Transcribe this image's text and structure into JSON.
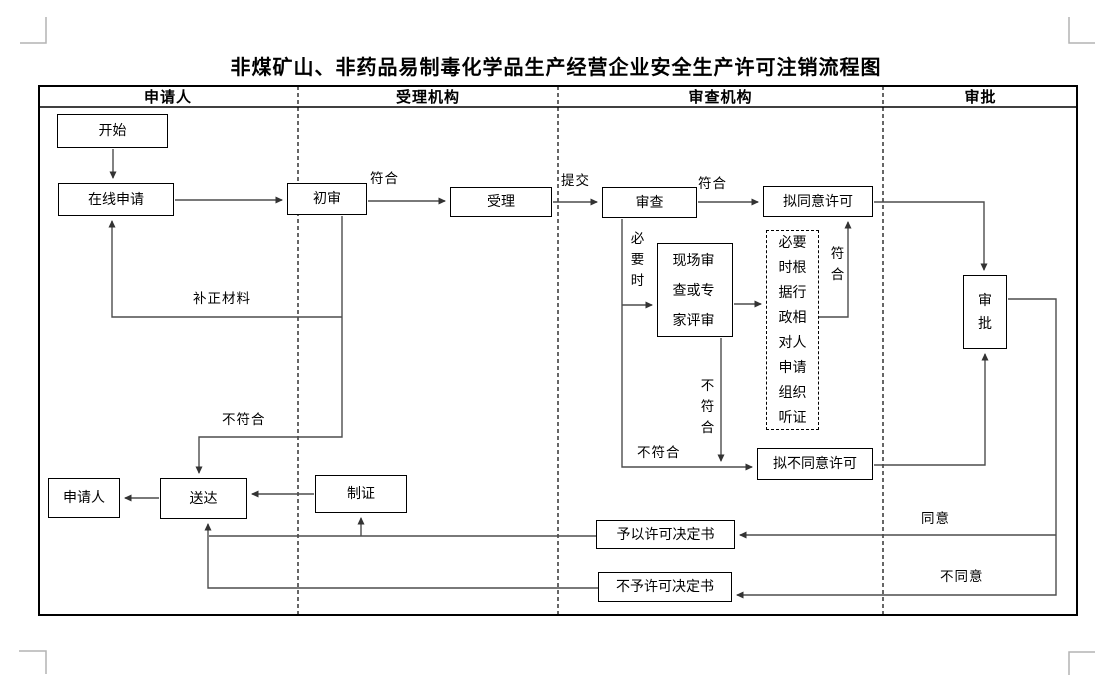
{
  "title": "非煤矿山、非药品易制毒化学品生产经营企业安全生产许可注销流程图",
  "lanes": [
    {
      "label": "申请人"
    },
    {
      "label": "受理机构"
    },
    {
      "label": "审查机构"
    },
    {
      "label": "审批"
    }
  ],
  "nodes": {
    "start": "开始",
    "online_apply": "在线申请",
    "preliminary_review": "初审",
    "accept": "受理",
    "review": "审查",
    "propose_approve": "拟同意许可",
    "onsite_review": "现场审查或专家评审",
    "hearing": "必要时根据行政相对人申请组织听证",
    "propose_disapprove": "拟不同意许可",
    "approve": "审批",
    "applicant": "申请人",
    "deliver": "送达",
    "make_certificate": "制证",
    "grant_decision": "予以许可决定书",
    "deny_decision": "不予许可决定书"
  },
  "edge_labels": {
    "conform_1": "符合",
    "submit": "提交",
    "conform_2": "符合",
    "when_necessary": "必要时",
    "conform_3": "符合",
    "not_conform_1": "不符合",
    "not_conform_2": "不符合",
    "not_conform_3": "不符合",
    "supplement_materials": "补正材料",
    "agree": "同意",
    "disagree": "不同意"
  },
  "colors": {
    "line": "#4d4d4d",
    "border": "#000000",
    "background": "#ffffff",
    "crop_mark": "#b3b3b3"
  }
}
